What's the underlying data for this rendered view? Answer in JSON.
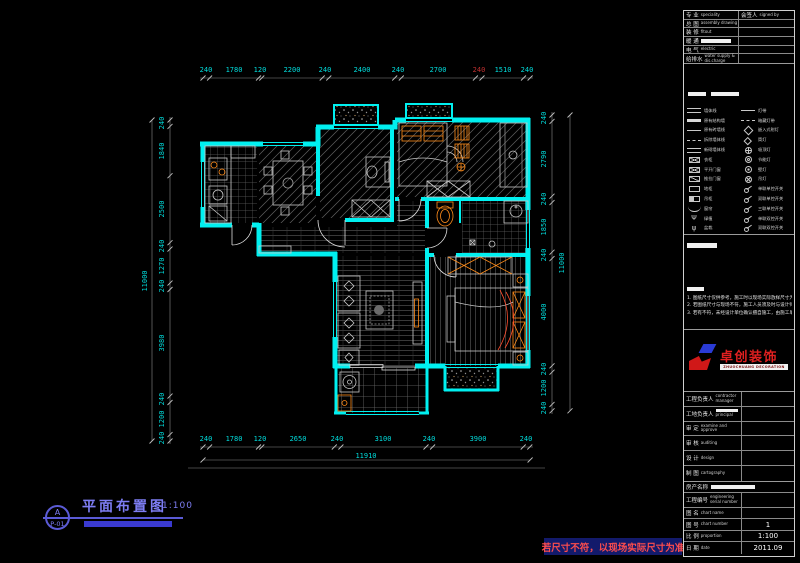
{
  "drawing": {
    "sheet_label": {
      "detail_letter": "A",
      "sheet_number": "P-01",
      "title": "平面布置图",
      "scale": "1:100"
    },
    "warning": "若尺寸不符，以现场实际尺寸为准",
    "dims": {
      "top": [
        "240",
        "1780",
        "120",
        "2200",
        "240",
        "2400",
        "240",
        "2700",
        "240",
        "1510",
        "240"
      ],
      "bottom": [
        "240",
        "1780",
        "120",
        "2650",
        "240",
        "3100",
        "240",
        "3900",
        "240"
      ],
      "left": [
        "240",
        "1840",
        "2500",
        "240",
        "1270",
        "240",
        "3980",
        "240",
        "1200",
        "240"
      ],
      "right": [
        "240",
        "2790",
        "240",
        "1850",
        "240",
        "4000",
        "240",
        "1200",
        "240"
      ],
      "overall_bottom": "11910",
      "overall_left": "11000",
      "overall_right": "11000"
    },
    "colors": {
      "wall": "#00f0f0",
      "dim_text": "#00dcdc",
      "dim_alert": "#c03030",
      "furniture": "#c9c9c9",
      "accent_orange": "#ff8c1a",
      "accent_red": "#ff4d2e",
      "label_blue": "#6a6ae8",
      "warning_bg": "#131a6b",
      "warning_text": "#ff4d4d"
    }
  },
  "titleblock": {
    "signoff": {
      "col1": {
        "cn": "专 业",
        "en": "speciality"
      },
      "col2": {
        "cn": "会签人",
        "en": "signed by"
      },
      "rows": [
        {
          "cn": "总 图",
          "en": "assembly drawing"
        },
        {
          "cn": "装 修",
          "en": "fitout"
        },
        {
          "cn": "暖 通",
          "en": ""
        },
        {
          "cn": "电 气",
          "en": "electric"
        },
        {
          "cn": "给排水",
          "en": "water supply & dis.charge"
        }
      ]
    },
    "legend_left": [
      {
        "icon": "wall-double-line",
        "label": "墙体线"
      },
      {
        "icon": "wall-thick-line",
        "label": "原有结构墙"
      },
      {
        "icon": "wall-line",
        "label": "原有砖墙线"
      },
      {
        "icon": "wall-dash-line",
        "label": "拆除墙体线"
      },
      {
        "icon": "wall-new-line",
        "label": "新砌墙体线"
      },
      {
        "icon": "wardrobe-box",
        "label": "衣柜"
      },
      {
        "icon": "x-box",
        "label": "平开门窗"
      },
      {
        "icon": "slash-box",
        "label": "推拉门窗"
      },
      {
        "icon": "plain-box",
        "label": "地柜"
      },
      {
        "icon": "half-box",
        "label": "吊柜"
      },
      {
        "icon": "curtain",
        "label": "窗帘"
      },
      {
        "icon": "plant",
        "label": "绿植"
      },
      {
        "icon": "plant-2",
        "label": "盆栽"
      }
    ],
    "legend_right": [
      {
        "icon": "line",
        "label": "灯带"
      },
      {
        "icon": "dash-line",
        "label": "暗藏灯带"
      },
      {
        "icon": "diamond",
        "label": "嵌入式射灯"
      },
      {
        "icon": "diamond-small",
        "label": "筒灯"
      },
      {
        "icon": "circle-cross",
        "label": "吸顶灯"
      },
      {
        "icon": "circle-ring",
        "label": "节能灯"
      },
      {
        "icon": "circle-dot",
        "label": "壁灯"
      },
      {
        "icon": "chandelier",
        "label": "吊灯"
      },
      {
        "icon": "switch-1",
        "label": "单联单控开关"
      },
      {
        "icon": "switch-2",
        "label": "双联单控开关"
      },
      {
        "icon": "switch-3",
        "label": "三联单控开关"
      },
      {
        "icon": "switch-4",
        "label": "单联双控开关"
      },
      {
        "icon": "switch-5",
        "label": "双联双控开关"
      }
    ],
    "notes": [
      "1. 图纸尺寸仅供参考，施工时以现场实际放样尺寸为准。",
      "2. 若图纸尺寸与现场不符，施工人员须及时与设计师联系。",
      "3. 若有不符，未经设计单位确认擅自施工，由施工单位负责。"
    ],
    "logo": {
      "name": "卓创装饰",
      "subtitle": "ZHUOCHUANG DECORATION"
    },
    "personnel": [
      {
        "cn": "工程负责人",
        "en": "contractor manager"
      },
      {
        "cn": "工地负责人",
        "en": "principal"
      },
      {
        "cn": "审 定",
        "en": "examine and approve"
      },
      {
        "cn": "审 核",
        "en": "auditing"
      },
      {
        "cn": "设 计",
        "en": "design"
      },
      {
        "cn": "制 图",
        "en": "cartography"
      }
    ],
    "project": {
      "property_label": "房产名称",
      "rows": [
        {
          "cn": "工程编号",
          "en": "engineering serial number",
          "value": ""
        },
        {
          "cn": "图  名",
          "en": "chart name",
          "value": ""
        },
        {
          "cn": "图  号",
          "en": "chart number",
          "value": "1"
        },
        {
          "cn": "比  例",
          "en": "proportion",
          "value": "1:100"
        },
        {
          "cn": "日  期",
          "en": "date",
          "value": "2011.09"
        }
      ]
    }
  }
}
